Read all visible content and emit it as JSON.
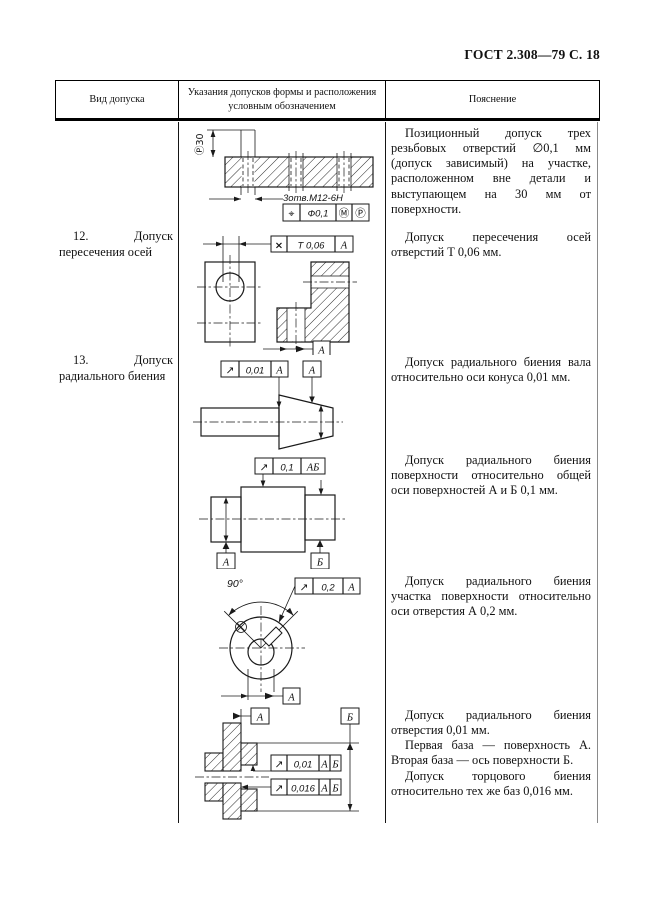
{
  "page": {
    "header_title": "ГОСТ 2.308—79 С. 18"
  },
  "table": {
    "col1_header": "Вид допуска",
    "col2_header": "Указания допусков формы и расположения условным обозначением",
    "col3_header": "Пояснение"
  },
  "row11": {
    "explanation": "Позиционный допуск трех резьбовых отверстий ∅0,1 мм (допуск зависимый) на участке, расположенном вне детали и выступающем на 30 мм от поверхности."
  },
  "row12": {
    "label": "12. Допуск пересечения осей",
    "explanation": "Допуск пересечения осей отверстий Т 0,06 мм."
  },
  "row13": {
    "label": "13. Допуск радиального биения",
    "explanation_cone": "Допуск радиального биения вала относительно оси конуса 0,01 мм.",
    "explanation_common_axis": "Допуск радиального биения поверхности относительно общей оси поверхностей А и Б 0,1 мм.",
    "explanation_sector": "Допуск радиального биения участка поверхности относительно оси отверстия А 0,2 мм.",
    "explanation_hole_1": "Допуск радиального биения отверстия 0,01 мм.",
    "explanation_hole_2": "Первая база — поверхность А. Вторая база — ось поверхности Б.",
    "explanation_hole_3": "Допуск торцового биения относительно тех же баз 0,016 мм."
  },
  "d1": {
    "proj_dim": "Ⓟ30",
    "note": "3отв.М12-6Н",
    "sym": "⌖",
    "value": "Ф0,1",
    "mod_m": "Ⓜ",
    "mod_p": "Ⓟ"
  },
  "d2": {
    "sym": "×",
    "value": "Т 0,06",
    "datum": "А",
    "datum_label": "А"
  },
  "d3": {
    "sym": "↗",
    "value": "0,01",
    "datum": "А",
    "datum_label": "А"
  },
  "d4": {
    "sym": "↗",
    "value": "0,1",
    "datum": "АБ",
    "datum_a": "А",
    "datum_b": "Б"
  },
  "d5": {
    "angle": "90°",
    "sym": "↗",
    "value": "0,2",
    "datum": "А",
    "datum_label": "А"
  },
  "d6": {
    "datum_a": "А",
    "datum_b": "Б",
    "sym1": "↗",
    "value1": "0,01",
    "ref1a": "А",
    "ref1b": "Б",
    "sym2": "↗",
    "value2": "0,016",
    "ref2a": "А",
    "ref2b": "Б"
  }
}
